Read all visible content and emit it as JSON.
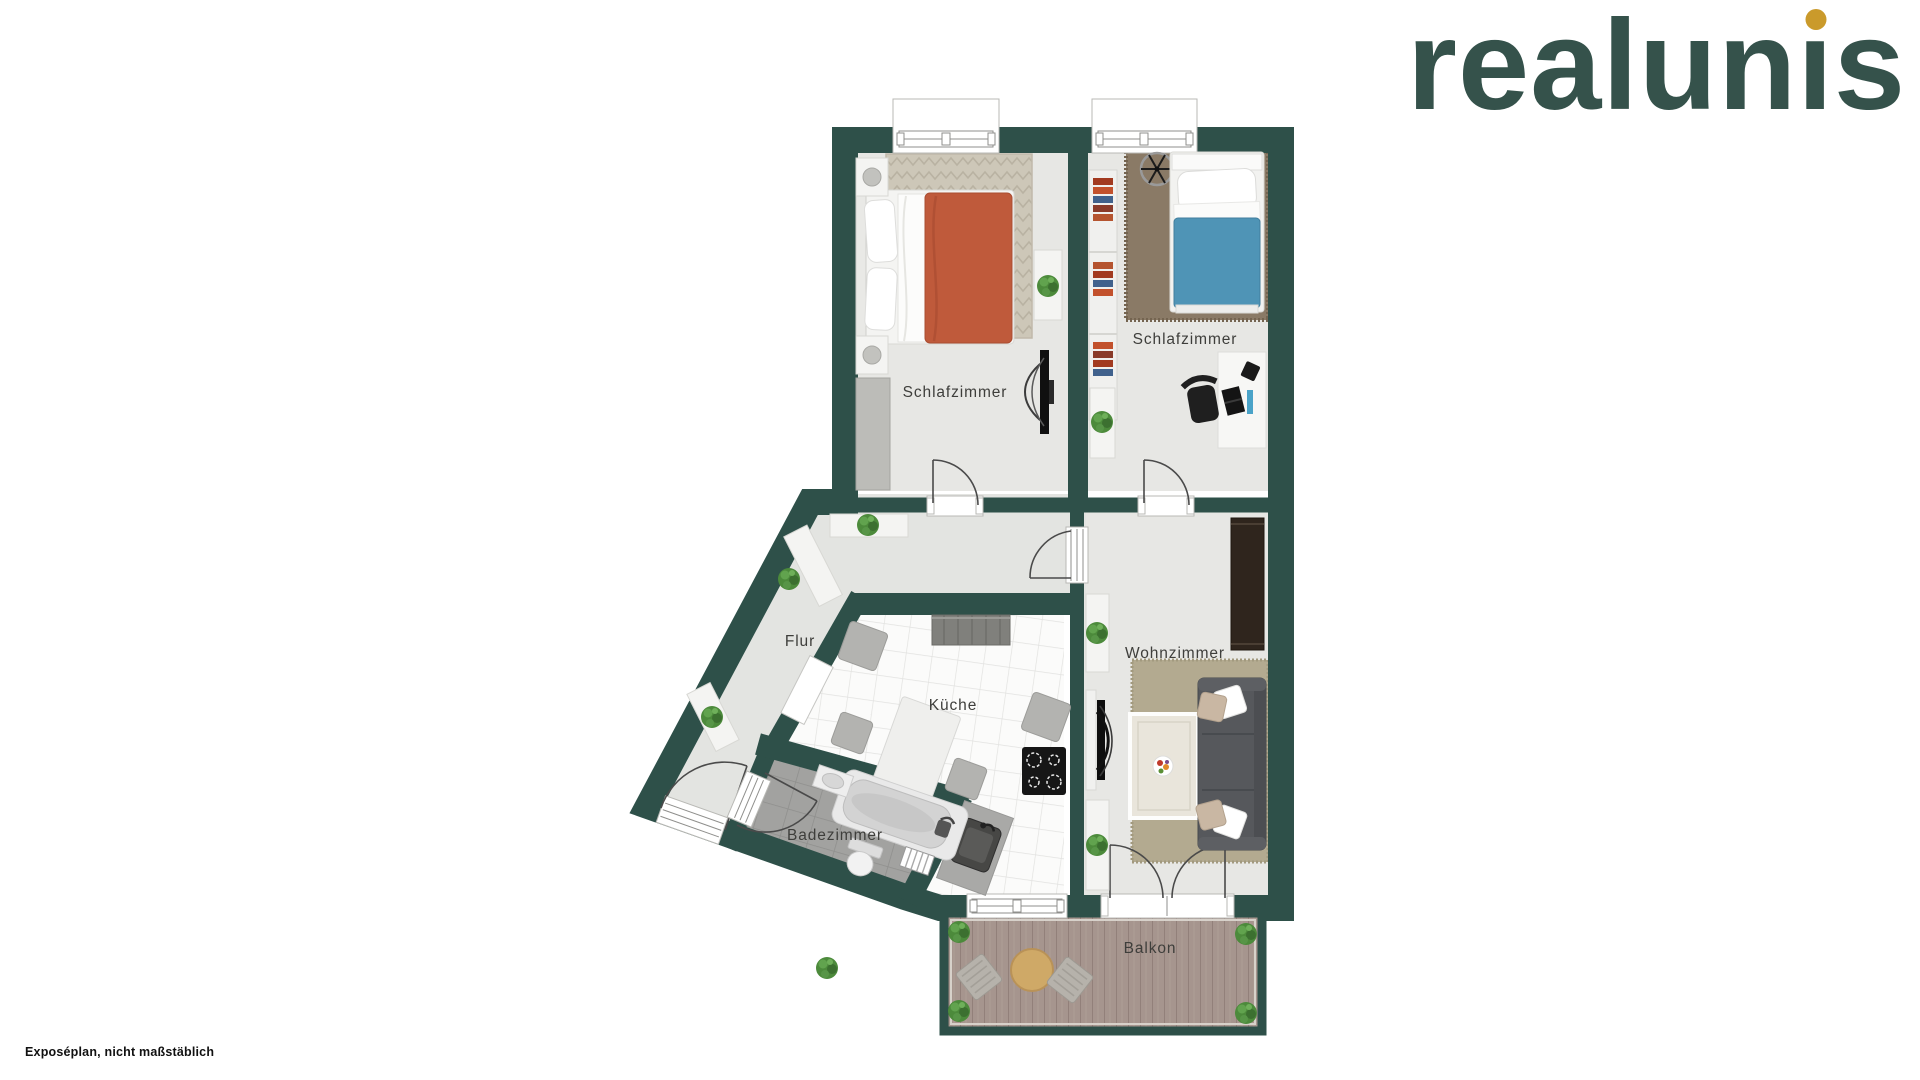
{
  "logo": {
    "full_text": "realunis",
    "before_i": "realun",
    "i_char": "ı",
    "after_i": "s"
  },
  "footer": {
    "note": "Exposéplan, nicht maßstäblich"
  },
  "floorplan": {
    "rooms": [
      {
        "id": "schlafzimmer-1",
        "label": "Schlafzimmer"
      },
      {
        "id": "schlafzimmer-2",
        "label": "Schlafzimmer"
      },
      {
        "id": "flur",
        "label": "Flur"
      },
      {
        "id": "kueche",
        "label": "Küche"
      },
      {
        "id": "badezimmer",
        "label": "Badezimmer"
      },
      {
        "id": "wohnzimmer",
        "label": "Wohnzimmer"
      },
      {
        "id": "balkon",
        "label": "Balkon"
      }
    ]
  },
  "colors": {
    "wall": "#2e5049",
    "floor": "#e7e7e4",
    "logo_text": "#35524b",
    "logo_dot": "#ca9a2b",
    "bed1_blanket": "#bf5a3b",
    "bed2_blanket": "#4f94b6",
    "sofa": "#56585c",
    "deck_wood": "#a6958e",
    "balcony_table": "#cfa967",
    "rug_bedroom1": "#cdc7b8",
    "rug_bedroom2": "#8a7a66",
    "rug_living": "#b3aa90",
    "plant_green": "#4c8a3b"
  }
}
